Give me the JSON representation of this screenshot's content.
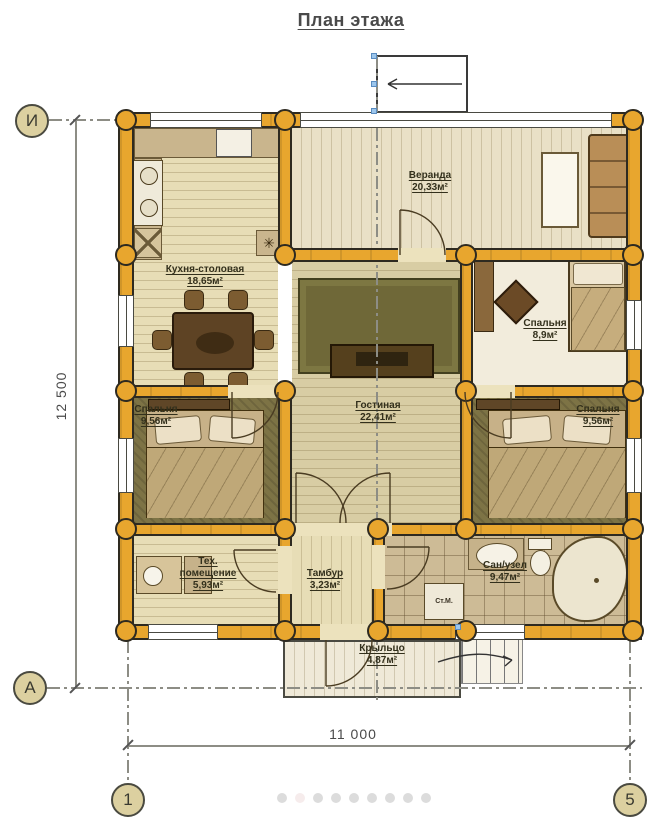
{
  "title": "План этажа",
  "rooms": [
    {
      "name": "Веранда",
      "area": "20,33м²"
    },
    {
      "name": "Кухня-столовая",
      "area": "18,65м²"
    },
    {
      "name": "Спальня",
      "area": "8,9м²"
    },
    {
      "name": "Гостиная",
      "area": "22,41м²"
    },
    {
      "name": "Спальня",
      "area": "9,56м²"
    },
    {
      "name": "Спальня",
      "area": "9,56м²"
    },
    {
      "name": "Тех. помещение",
      "area": "5,93м²"
    },
    {
      "name": "Тамбур",
      "area": "3,23м²"
    },
    {
      "name": "Сан/узел",
      "area": "9,47м²"
    },
    {
      "name": "Крыльцо",
      "area": "4,87м²"
    }
  ],
  "labels": {
    "washing_machine": "Ст.М."
  },
  "axes": {
    "row_top": "И",
    "row_bottom": "А",
    "col_left": "1",
    "col_right": "5"
  },
  "dimensions": {
    "height": "12 500",
    "width": "11 000"
  },
  "pagination": {
    "count": 9,
    "active_index": 1
  },
  "colors": {
    "wall": "#e8a62e",
    "wall_outline": "#2e2a20",
    "floor_light": "#e7ddb6",
    "floor_veranda": "#e9e0c6",
    "floor_living": "#d8cda4",
    "floor_dark": "#7d7345",
    "floor_bath": "#cdbb96",
    "floor_bedroom_white": "#f2ecdc",
    "porch": "#efe9d8",
    "rug": "#6f6838",
    "furniture_dark": "#5e4324",
    "furniture_tan": "#c9b58d",
    "bed": "#c3ad7e",
    "axis_circle": "#dcd0a0",
    "line_gray": "#8d8d85",
    "dot": "#dcdcdc",
    "dot_active": "#f6ecec",
    "title_text": "#4a4a4a",
    "label_text": "#33301c",
    "accent_blue": "#9cc6ec"
  }
}
